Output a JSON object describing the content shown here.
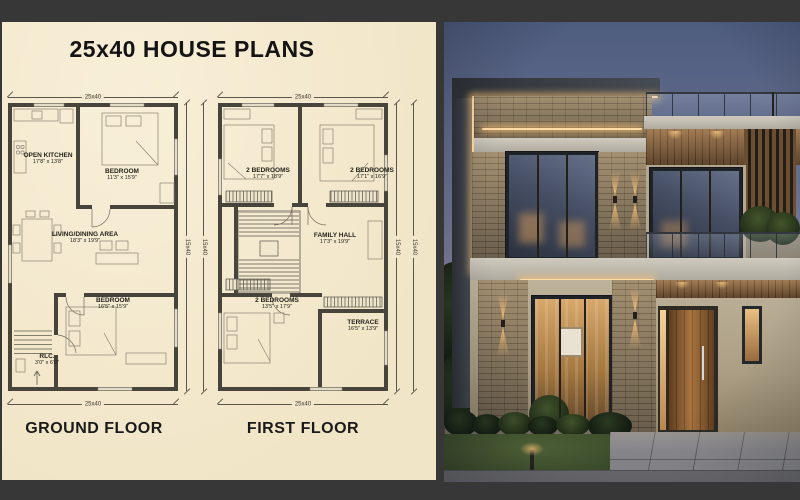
{
  "title": "25x40 HOUSE PLANS",
  "plans": {
    "ground": {
      "floor_label": "GROUND FLOOR",
      "dim_top": "25x40",
      "dim_bottom": "25x40",
      "dim_side_a": "15x40",
      "dim_side_b": "15x40",
      "rooms": [
        {
          "name": "OPEN KITCHEN",
          "size": "17'8\" x 13'8\""
        },
        {
          "name": "BEDROOM",
          "size": "11'3\" x 15'9\""
        },
        {
          "name": "LIVING/DINING AREA",
          "size": "18'3\" x 19'9\""
        },
        {
          "name": "BEDROOM",
          "size": "16'5\" x 15'9\""
        },
        {
          "name": "RLC.",
          "size": "3'0\" x 6'0\""
        }
      ]
    },
    "first": {
      "floor_label": "FIRST FLOOR",
      "dim_top": "25x40",
      "dim_bottom": "25x40",
      "dim_side_a": "15x40",
      "dim_side_b": "15x40",
      "rooms": [
        {
          "name": "2 BEDROOMS",
          "size": "17'7\" x 18'9\""
        },
        {
          "name": "2 BEDROOMS",
          "size": "17'1\" x 16'9\""
        },
        {
          "name": "FAMILY HALL",
          "size": "17'3\" x 19'9\""
        },
        {
          "name": "2 BEDROOMS",
          "size": "13'5\" x 17'9\""
        },
        {
          "name": "TERRACE",
          "size": "16'5\" x 13'9\""
        }
      ]
    }
  },
  "photo_colors": {
    "sky_top": "#4e5c7e",
    "sky_bottom": "#aba3a9",
    "roof": "#3a3e44",
    "led_strip": "#ffdba6",
    "stone": "#8f8069",
    "stucco": "#bdb199",
    "wood_door": "#8a5a2e",
    "lawn": "#3f5130",
    "paving": "#8b8b8f"
  },
  "frame_color": "#373737"
}
